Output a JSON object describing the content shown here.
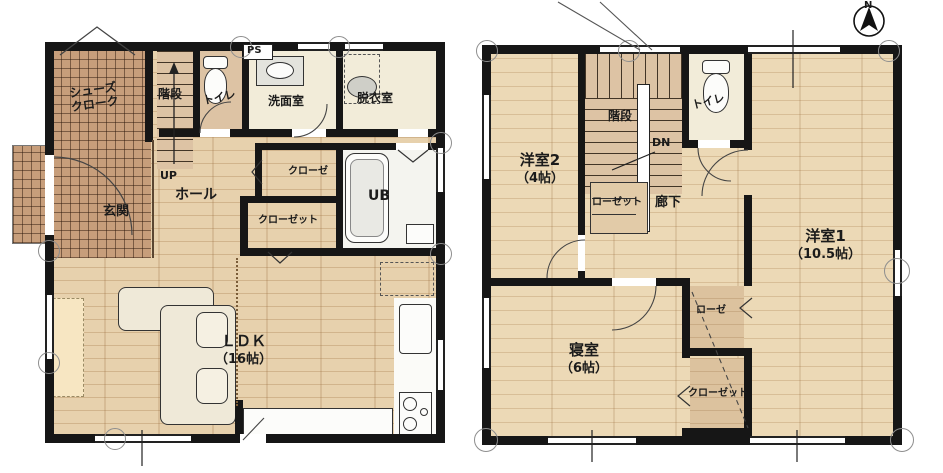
{
  "title": "2-story house floor plan (1F / 2F)",
  "compass": {
    "north_label": "N"
  },
  "colors": {
    "wall": "#161616",
    "wood_floor_1f": "#e7d1ad",
    "wood_floor_2f": "#ecd9b6",
    "entrance_tile": "#c79e7b",
    "wet_room_floor": "#f2ecd9",
    "stair_floor": "#ddc3a4",
    "background": "#ffffff"
  },
  "floor1": {
    "shoes_closet_line1": "シューズ",
    "shoes_closet_line2": "クローク",
    "stairs": "階段",
    "up": "UP",
    "toilet": "トイレ",
    "ps": "PS",
    "washroom": "洗面室",
    "dressing_room": "脱衣室",
    "entrance": "玄関",
    "hall": "ホール",
    "closet_upper": "クローゼ",
    "closet_lower": "クローゼット",
    "unit_bath": "UB",
    "ldk_name": "ＬＤＫ",
    "ldk_size": "（16帖）"
  },
  "floor2": {
    "western_room2_name": "洋室2",
    "western_room2_size": "（4帖）",
    "stairs": "階段",
    "down": "DN",
    "toilet": "トイレ",
    "hall_closet": "ローゼット",
    "corridor": "廊下",
    "western_room1_name": "洋室1",
    "western_room1_size": "（10.5帖）",
    "bedroom_name": "寝室",
    "bedroom_size": "（6帖）",
    "closet_upper": "ローゼ",
    "closet_lower": "クローゼット"
  }
}
